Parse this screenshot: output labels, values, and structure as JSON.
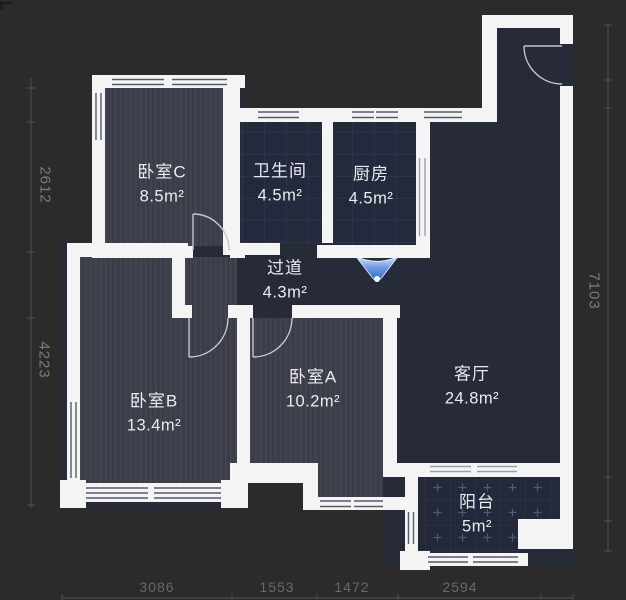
{
  "rooms": [
    {
      "id": "bedroom-c",
      "name": "卧室C",
      "area": "8.5m²"
    },
    {
      "id": "bathroom",
      "name": "卫生间",
      "area": "4.5m²"
    },
    {
      "id": "kitchen",
      "name": "厨房",
      "area": "4.5m²"
    },
    {
      "id": "hallway",
      "name": "过道",
      "area": "4.3m²"
    },
    {
      "id": "bedroom-b",
      "name": "卧室B",
      "area": "13.4m²"
    },
    {
      "id": "bedroom-a",
      "name": "卧室A",
      "area": "10.2m²"
    },
    {
      "id": "living-room",
      "name": "客厅",
      "area": "24.8m²"
    },
    {
      "id": "balcony",
      "name": "阳台",
      "area": "5m²"
    }
  ],
  "dimensions": {
    "left": [
      {
        "value": "2612"
      },
      {
        "value": "4223"
      }
    ],
    "right": [
      {
        "value": "7103"
      }
    ],
    "bottom": [
      {
        "value": "3086"
      },
      {
        "value": "1553"
      },
      {
        "value": "1472"
      },
      {
        "value": "2594"
      }
    ]
  },
  "colors": {
    "background": "#2b2b2b",
    "wall": "#f4f4f5",
    "bedroom_floor": "#3b3e49",
    "tile_floor": "#242a3c",
    "living_floor": "#272b37",
    "entry_marker_blue": "#3a72d0",
    "dimension_text": "#6f6f73",
    "label_text": "#e9ebee"
  }
}
